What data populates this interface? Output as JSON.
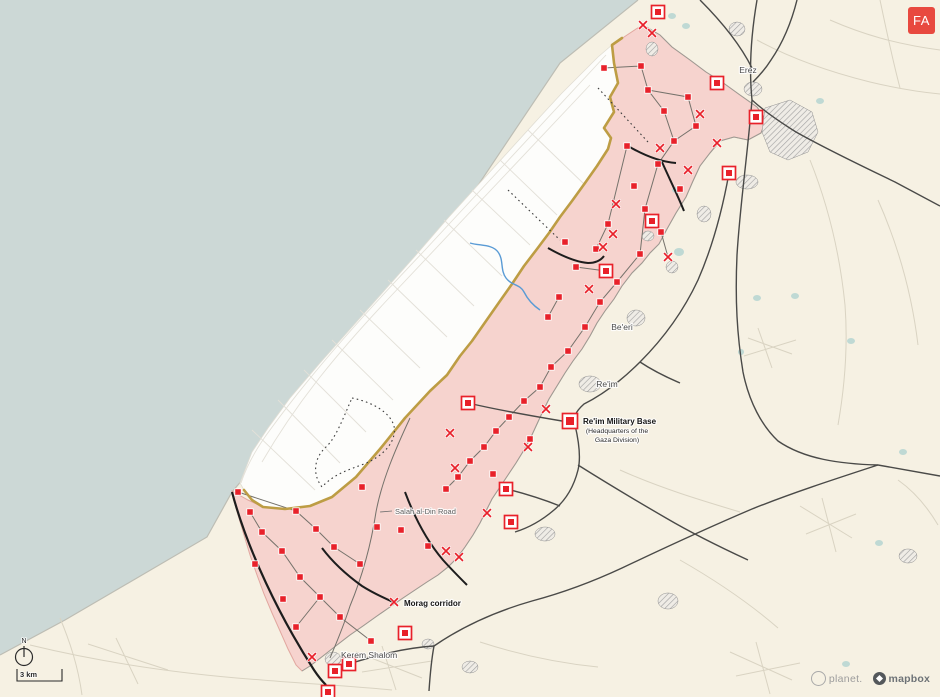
{
  "badge": {
    "label": "FA",
    "bg": "#e8493f",
    "fg": "#ffffff"
  },
  "attribution": {
    "planet": "planet.",
    "mapbox": "mapbox"
  },
  "map": {
    "colors": {
      "sea": "#ccd8d6",
      "land": "#f6f1e3",
      "gaza_clear_zone": "#fdfdfb",
      "occupied_zone_pink": "#f5d0cc",
      "occupied_zone_edge": "#d98f88",
      "yellow_line_gold": "#bd9d44",
      "marker_red": "#e8212a",
      "road_dark": "#4a4a48",
      "road_black": "#1d1d1d",
      "water_blue": "#5a9bd5",
      "pond_teal": "#bfd9d4"
    },
    "compass": {
      "label": "N"
    },
    "scale": {
      "label": "3 km"
    },
    "labels": [
      {
        "id": "erez",
        "text": "Erez",
        "x": 748,
        "y": 73,
        "style": "place"
      },
      {
        "id": "beeri",
        "text": "Be'eri",
        "x": 622,
        "y": 330,
        "style": "place"
      },
      {
        "id": "reim",
        "text": "Re'im",
        "x": 607,
        "y": 387,
        "style": "place"
      },
      {
        "id": "reim-base-title",
        "text": "Re'im Military Base",
        "x": 583,
        "y": 424,
        "style": "poi-title",
        "anchor": "start"
      },
      {
        "id": "reim-base-sub1",
        "text": "(Headquarters of the",
        "x": 617,
        "y": 433,
        "style": "poi-sub"
      },
      {
        "id": "reim-base-sub2",
        "text": "Gaza Division)",
        "x": 617,
        "y": 442,
        "style": "poi-sub"
      },
      {
        "id": "salah-al-din-road",
        "text": "Salah al-Din Road",
        "x": 395,
        "y": 514,
        "style": "road",
        "anchor": "start",
        "leader": [
          380,
          512,
          392,
          511
        ]
      },
      {
        "id": "morag-corridor",
        "text": "Morag corridor",
        "x": 404,
        "y": 606,
        "style": "corridor",
        "anchor": "start"
      },
      {
        "id": "kerem-shalom",
        "text": "Kerem Shalom",
        "x": 341,
        "y": 658,
        "style": "place",
        "anchor": "start"
      }
    ],
    "markers": {
      "hq": [
        {
          "x": 658,
          "y": 12
        },
        {
          "x": 717,
          "y": 83
        },
        {
          "x": 756,
          "y": 117
        },
        {
          "x": 729,
          "y": 173
        },
        {
          "x": 652,
          "y": 221
        },
        {
          "x": 606,
          "y": 271
        },
        {
          "x": 570,
          "y": 421,
          "s": 15
        },
        {
          "x": 468,
          "y": 403
        },
        {
          "x": 506,
          "y": 489
        },
        {
          "x": 511,
          "y": 522
        },
        {
          "x": 405,
          "y": 633
        },
        {
          "x": 349,
          "y": 664
        },
        {
          "x": 335,
          "y": 671
        },
        {
          "x": 328,
          "y": 692
        }
      ],
      "posts": [
        [
          604,
          68
        ],
        [
          641,
          66
        ],
        [
          648,
          90
        ],
        [
          688,
          97
        ],
        [
          664,
          111
        ],
        [
          696,
          126
        ],
        [
          674,
          141
        ],
        [
          627,
          146
        ],
        [
          658,
          164
        ],
        [
          634,
          186
        ],
        [
          680,
          189
        ],
        [
          645,
          209
        ],
        [
          608,
          224
        ],
        [
          661,
          232
        ],
        [
          596,
          249
        ],
        [
          640,
          254
        ],
        [
          565,
          242
        ],
        [
          576,
          267
        ],
        [
          617,
          282
        ],
        [
          559,
          297
        ],
        [
          600,
          302
        ],
        [
          548,
          317
        ],
        [
          585,
          327
        ],
        [
          568,
          351
        ],
        [
          551,
          367
        ],
        [
          540,
          387
        ],
        [
          524,
          401
        ],
        [
          509,
          417
        ],
        [
          530,
          439
        ],
        [
          496,
          431
        ],
        [
          484,
          447
        ],
        [
          470,
          461
        ],
        [
          493,
          474
        ],
        [
          458,
          477
        ],
        [
          446,
          489
        ],
        [
          238,
          492
        ],
        [
          250,
          512
        ],
        [
          262,
          532
        ],
        [
          296,
          511
        ],
        [
          316,
          529
        ],
        [
          282,
          551
        ],
        [
          334,
          547
        ],
        [
          255,
          564
        ],
        [
          300,
          577
        ],
        [
          360,
          564
        ],
        [
          320,
          597
        ],
        [
          283,
          599
        ],
        [
          340,
          617
        ],
        [
          296,
          627
        ],
        [
          371,
          641
        ],
        [
          362,
          487
        ],
        [
          377,
          527
        ],
        [
          401,
          530
        ],
        [
          428,
          546
        ]
      ],
      "clashes": [
        [
          643,
          25
        ],
        [
          652,
          33
        ],
        [
          700,
          114
        ],
        [
          717,
          143
        ],
        [
          660,
          148
        ],
        [
          688,
          170
        ],
        [
          616,
          204
        ],
        [
          613,
          234
        ],
        [
          603,
          247
        ],
        [
          668,
          257
        ],
        [
          589,
          289
        ],
        [
          546,
          409
        ],
        [
          528,
          447
        ],
        [
          450,
          433
        ],
        [
          455,
          468
        ],
        [
          487,
          513
        ],
        [
          459,
          557
        ],
        [
          394,
          602
        ],
        [
          312,
          657
        ],
        [
          446,
          551
        ]
      ]
    }
  }
}
